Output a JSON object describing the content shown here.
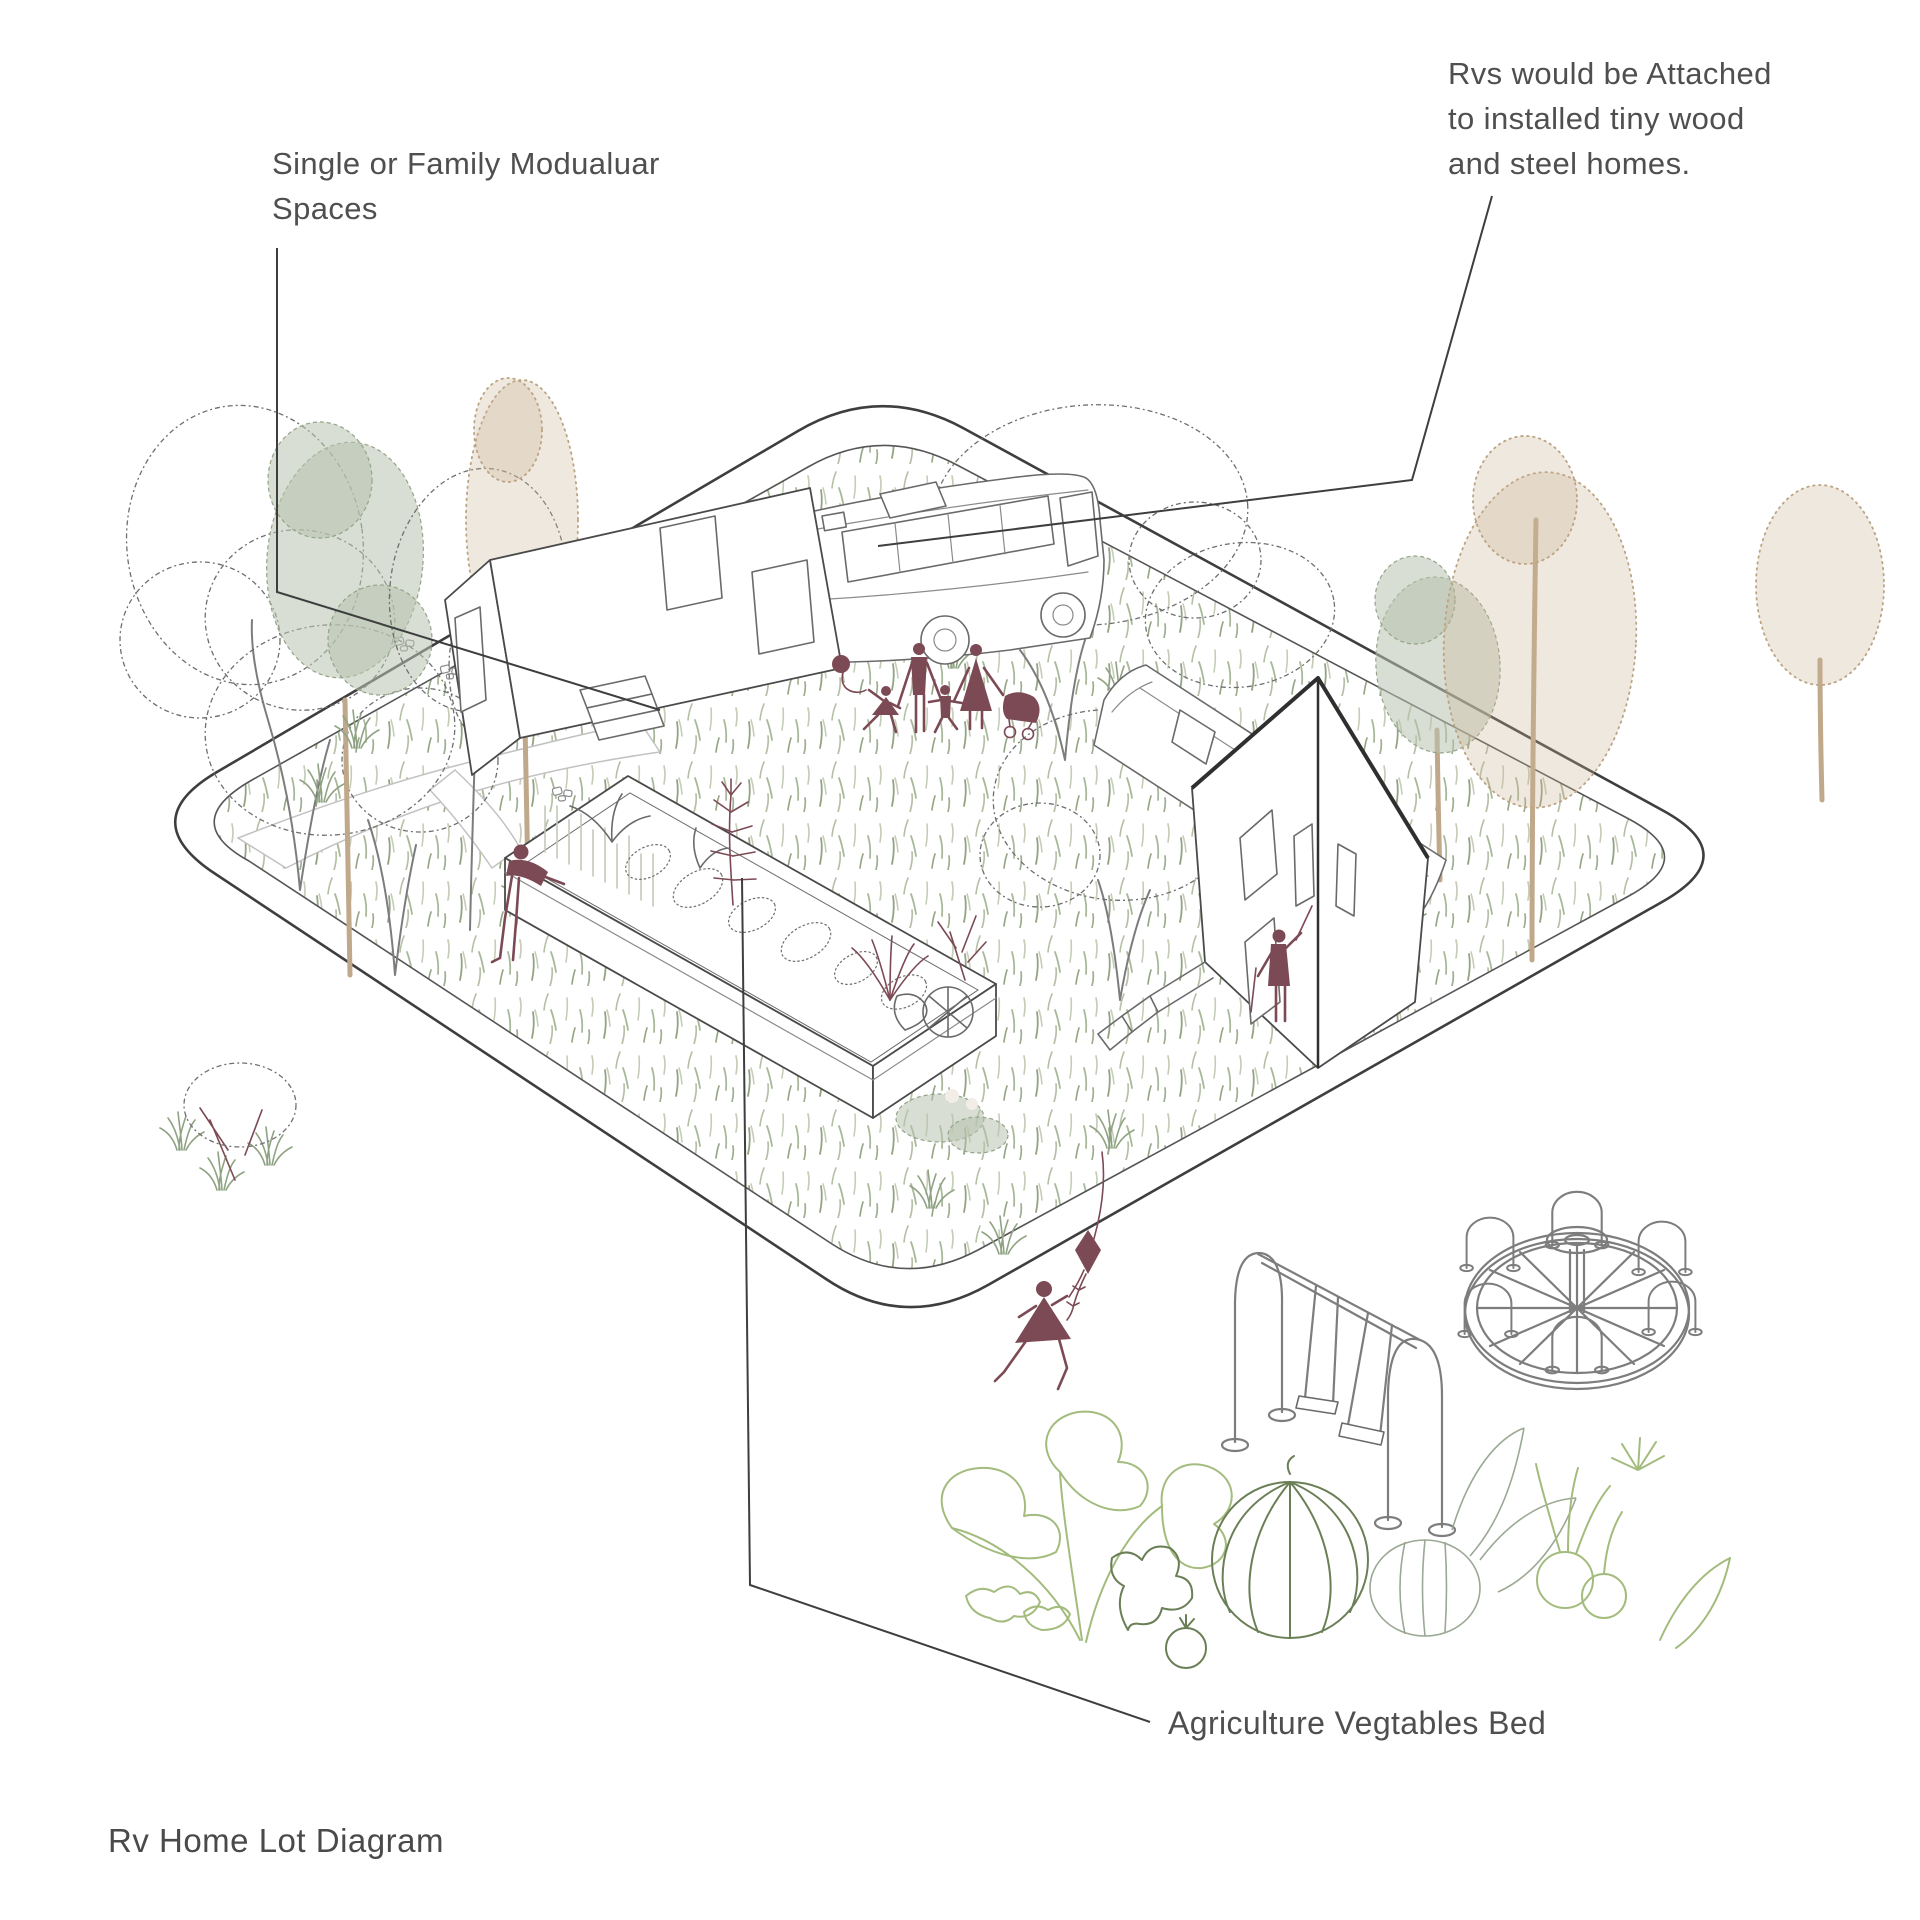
{
  "title": {
    "text": "Rv Home Lot Diagram"
  },
  "annotations": {
    "modular_spaces": {
      "lines": [
        "Single or Family Modualuar",
        "Spaces"
      ]
    },
    "rv_attached": {
      "lines": [
        "Rvs would be Attached",
        "to installed tiny wood",
        "and steel homes."
      ]
    },
    "vegetable_bed": {
      "text": "Agriculture Vegtables Bed"
    }
  },
  "colors": {
    "ink": "#3e3e3e",
    "sketch_gray": "#6e6e6e",
    "accent_maroon": "#7c4a54",
    "sage_fill": "#b8c3ae",
    "tan_fill": "#c9b394",
    "grass_green": "#a9b89a",
    "vegetable_green": "#a3bc7d",
    "label_text": "#4f4f4f"
  },
  "scene": {
    "parts": [
      "lot-boundary",
      "grass-field",
      "footpath",
      "stepping-stones",
      "tiny-home",
      "attached-rv",
      "second-tiny-home",
      "second-rv",
      "raised-garden-bed",
      "family-figures",
      "gardener-figure",
      "resident-figure",
      "running-child-with-kite",
      "swing-set",
      "merry-go-round",
      "vegetable-row",
      "trees",
      "leader-lines"
    ]
  }
}
